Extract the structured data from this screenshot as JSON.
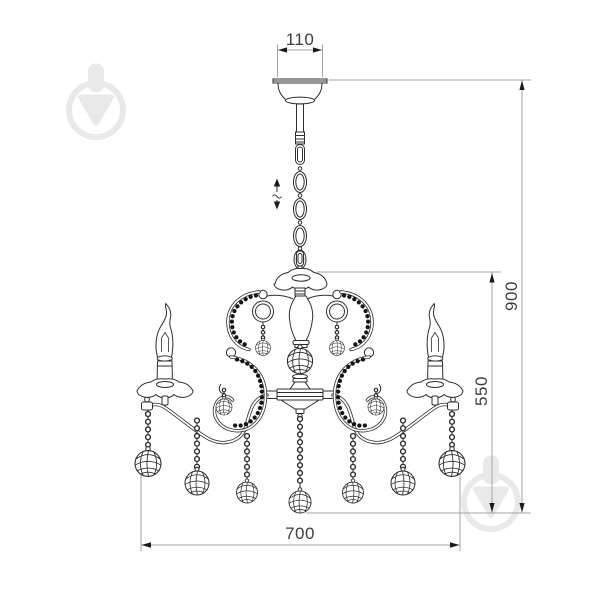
{
  "title": "Chandelier dimensional drawing",
  "dimensions": {
    "canopy_width": "110",
    "overall_height": "900",
    "body_height": "550",
    "overall_width": "700"
  },
  "icons": {
    "height_adjustable": "up-down-arrows-icon",
    "watermark_logo": "circle-down-arrow-logo-icon"
  },
  "watermarks": [
    "top-left",
    "bottom-right"
  ],
  "colors": {
    "background": "#ffffff",
    "drawing_line": "#2e2e2e",
    "dimension_line": "#a3a3a3",
    "dimension_text": "#3d3d3d",
    "arrowhead": "#1a1a1a",
    "watermark": "#e9e9e9"
  }
}
